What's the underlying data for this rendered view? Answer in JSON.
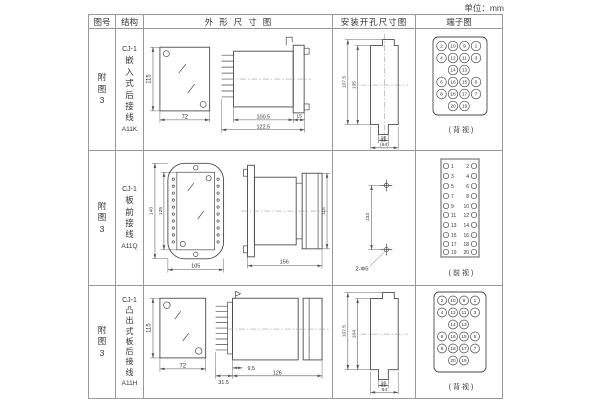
{
  "unit_label": "单位：mm",
  "headers": {
    "fig_no": "图号",
    "structure": "结构",
    "outline": "外形尺寸图",
    "mounting": "安装开孔尺寸图",
    "terminal": "端子图"
  },
  "rows": [
    {
      "fig_no": "附图3",
      "structure": {
        "model": "CJ-1",
        "name": "嵌入式后接线",
        "code": "A11K"
      },
      "outline": {
        "front_h": "115",
        "front_w": "72",
        "body_len": "100.5",
        "overall_len": "122.5",
        "flange_t": "15"
      },
      "mounting": {
        "outer_h": "107.5",
        "inner_h": "105",
        "tab_w": "16",
        "opening_w": "(64)"
      },
      "terminal": {
        "numbers": [
          "2",
          "10",
          "9",
          "1",
          "4",
          "12",
          "11",
          "3",
          "14",
          "13",
          "6",
          "16",
          "15",
          "5",
          "8",
          "18",
          "17",
          "7",
          "20",
          "19"
        ],
        "caption": "(背视)"
      }
    },
    {
      "fig_no": "附图3",
      "structure": {
        "model": "CJ-1",
        "name": "板前接线",
        "code": "A11Q"
      },
      "outline": {
        "front_outer_h": "140",
        "front_inner_h": "125",
        "front_w": "105",
        "side_len": "156",
        "side_h": "115"
      },
      "mounting": {
        "hole_spacing": "133",
        "holes": "2-Φ5"
      },
      "terminal": {
        "odd": [
          "1",
          "3",
          "5",
          "7",
          "9",
          "11",
          "13",
          "15",
          "17",
          "19"
        ],
        "even": [
          "2",
          "4",
          "6",
          "8",
          "10",
          "12",
          "14",
          "16",
          "18",
          "20"
        ],
        "caption": "(前视)"
      }
    },
    {
      "fig_no": "附图3",
      "structure": {
        "model": "CJ-1",
        "name": "凸出式板后接线",
        "code": "A11H"
      },
      "outline": {
        "front_h": "115",
        "front_w": "72",
        "pin_len": "9.5",
        "stud_len": "31.5",
        "overall_len": "126"
      },
      "mounting": {
        "outer_h": "107.5",
        "inner_h": "104",
        "tab_w": "16",
        "opening_w": "64"
      },
      "terminal": {
        "numbers": [
          "2",
          "10",
          "9",
          "1",
          "4",
          "12",
          "11",
          "3",
          "14",
          "13",
          "6",
          "16",
          "15",
          "5",
          "8",
          "18",
          "17",
          "7",
          "20",
          "19"
        ],
        "caption": "(背视)"
      }
    }
  ]
}
